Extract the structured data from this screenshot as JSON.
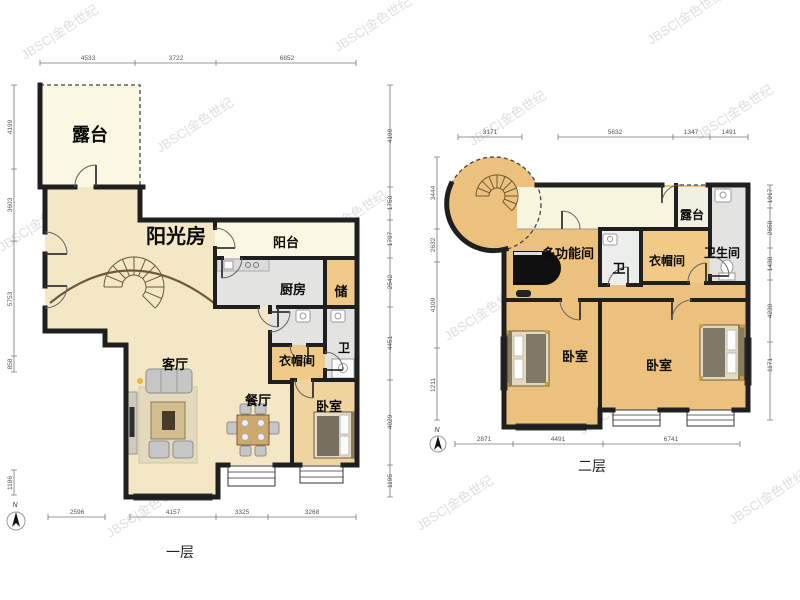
{
  "watermark": "JBSC|金色世纪",
  "floor1": {
    "label": "一层",
    "compass": "N",
    "rooms": {
      "terrace": "露台",
      "sunroom": "阳光房",
      "balcony": "阳台",
      "kitchen": "厨房",
      "storage": "储",
      "living": "客厅",
      "dining": "餐厅",
      "bedroom": "卧室",
      "cloakroom": "衣帽间",
      "bath": "卫"
    },
    "dims": {
      "top": [
        "4533",
        "3722",
        "6852"
      ],
      "bottom": [
        "2596",
        "4157",
        "3325",
        "3268"
      ],
      "left": [
        "4199",
        "3603",
        "5753",
        "858",
        "1186"
      ],
      "right": [
        "4199",
        "1750",
        "1797",
        "2542",
        "4451",
        "4029",
        "1195"
      ]
    }
  },
  "floor2": {
    "label": "二层",
    "compass": "N",
    "rooms": {
      "terrace": "露台",
      "multifunction": "多功能间",
      "bath_small": "卫",
      "cloakroom": "衣帽间",
      "bathroom": "卫生间",
      "bedroom_left": "卧室",
      "bedroom_right": "卧室"
    },
    "dims": {
      "top": [
        "3171",
        "5632",
        "1347",
        "1491"
      ],
      "bottom": [
        "2871",
        "4491",
        "6741"
      ],
      "left": [
        "3444",
        "2632",
        "4109",
        "1211"
      ],
      "right": [
        "1917",
        "2658",
        "1438",
        "4239",
        "1171"
      ]
    }
  },
  "colors": {
    "wall": "#1f1f1f",
    "floor_tan": "#f4e7c5",
    "floor_pale": "#faf7e2",
    "floor_orange": "#eec987",
    "floor_grey": "#e3e3e1",
    "floor2_tan": "#ecc17d"
  }
}
